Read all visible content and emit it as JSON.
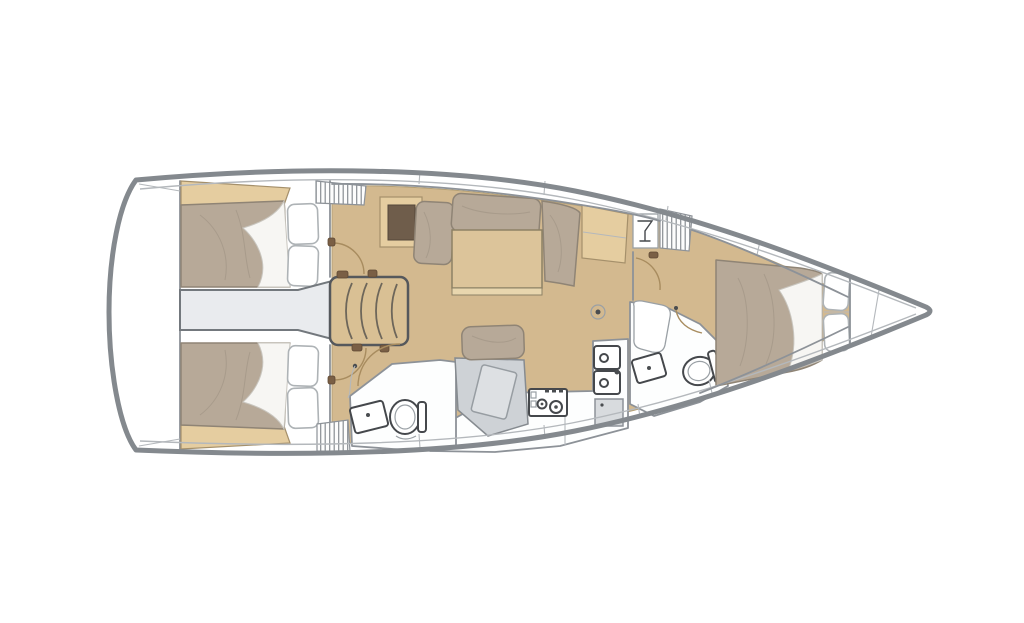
{
  "page": {
    "background": "#ffffff",
    "width": 1024,
    "height": 623,
    "kind": "sailing-yacht-interior-floorplan",
    "orientation": "bow-right"
  },
  "palette": {
    "hull_stroke": "#84898e",
    "inner_stroke": "#b4b8bc",
    "wall_stroke": "#8d9298",
    "floor_wood": "#d3b98f",
    "cabinet_wood": "#e5cda0",
    "mattress": "#b7a998",
    "white_surface": "#fdfefe",
    "engine_gray": "#e9ebee",
    "desk_gray": "#ced2d6",
    "dark_inset": "#6f5d4b",
    "door_arc": "#a88c5f",
    "fitting_dark": "#4a4d50",
    "steps_wood": "#d9c094",
    "table_wood": "#dcc49a"
  },
  "labels": {
    "hull": "Sailboat hull, bow pointing right",
    "transom": "Stern transom and lazarette",
    "aft_cabin_port": "Aft double cabin (top) with berth and pillows",
    "aft_cabin_starboard": "Aft double cabin (bottom) with berth and pillows",
    "engine_compartment": "Engine compartment between aft cabins",
    "companionway_steps": "Companionway steps",
    "salon": "Salon with settee cushions and table",
    "salon_cabinet": "Salon cabinet with dark inset",
    "sideboard": "Sideboard counter",
    "glass_locker": "Glassware locker",
    "hanging_locker": "Hanging locker (hatched)",
    "nav_station": "Navigation station seat and chart table",
    "aft_head": "Aft head with toilet and washbasin",
    "galley": "Galley with stove, double sink and locker",
    "forward_head": "Forward head with toilet and washbasin",
    "forward_cabin": "Forward cabin with island double berth",
    "bow_locker": "Bow anchor locker",
    "floor_fitting": "Round floor fitting"
  }
}
